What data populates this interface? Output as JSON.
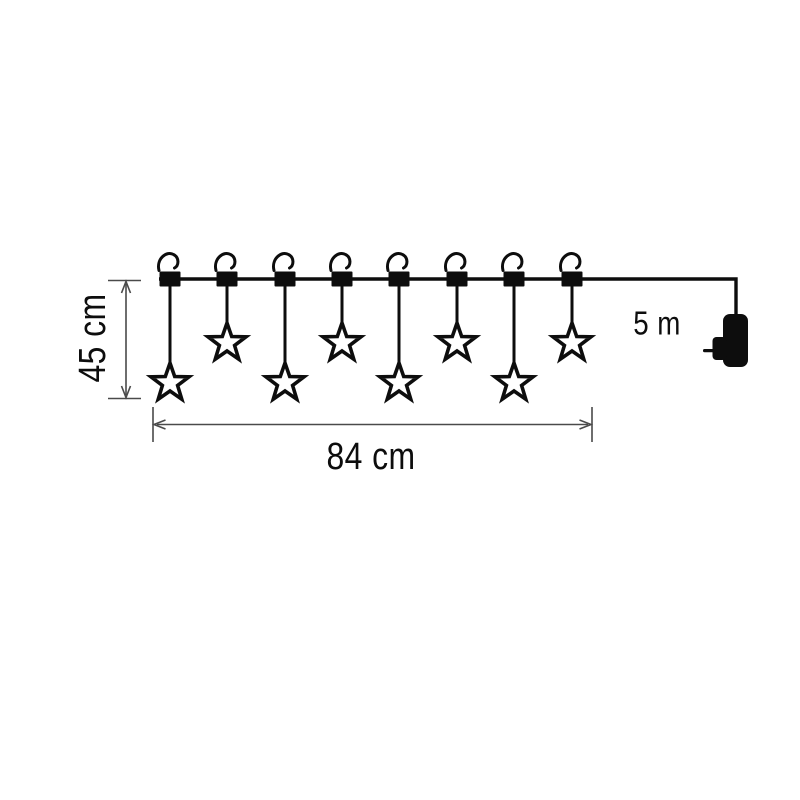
{
  "diagram": {
    "title": "star curtain light string dimension drawing",
    "colors": {
      "background": "#ffffff",
      "ink": "#0d0d0d",
      "dimension_line": "#4a4a4a"
    },
    "dimensions": {
      "height_label": "45 cm",
      "width_label": "84 cm",
      "cable_label": "5 m"
    },
    "lights": {
      "hook_count": 8,
      "star_count": 8,
      "wire_y": 279,
      "drops": [
        {
          "x": 170,
          "length": "long"
        },
        {
          "x": 227,
          "length": "short"
        },
        {
          "x": 285,
          "length": "long"
        },
        {
          "x": 342,
          "length": "short"
        },
        {
          "x": 399,
          "length": "long"
        },
        {
          "x": 457,
          "length": "short"
        },
        {
          "x": 514,
          "length": "long"
        },
        {
          "x": 572,
          "length": "short"
        }
      ],
      "drop_geometry": {
        "string_top_y": 286,
        "long_star_center_y": 383,
        "short_star_center_y": 343,
        "star_outer_radius": 20
      }
    },
    "icons": [
      "hook-icon",
      "star-light-icon",
      "power-plug-icon"
    ]
  }
}
